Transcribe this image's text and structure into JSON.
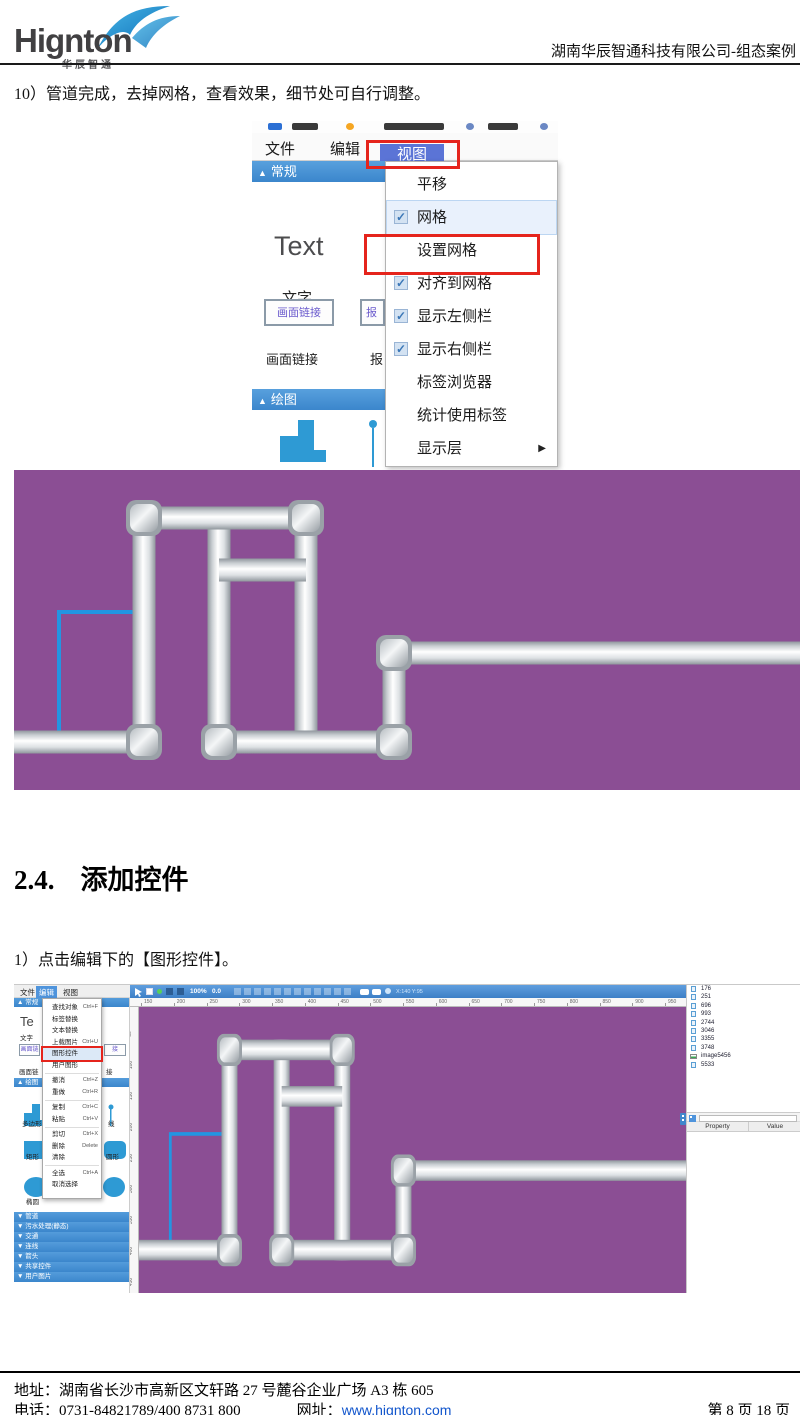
{
  "header": {
    "logo": "Hignton",
    "logo_sub": "华辰智通",
    "doc_title": "湖南华辰智通科技有限公司-组态案例"
  },
  "step10_text": "10）管道完成，去掉网格，查看效果，细节处可自行调整。",
  "section": {
    "number": "2.4.",
    "title": "添加控件"
  },
  "step1_text": "1）点击编辑下的【图形控件】。",
  "footer": {
    "address": "地址：湖南省长沙市高新区文轩路 27 号麓谷企业广场 A3 栋 605",
    "phone": "电话：0731-84821789/400 8731 800",
    "site_label": "网址：",
    "site": "www.hignton.com",
    "page_info": "第 8 页 18 页"
  },
  "shot1": {
    "menu": [
      "文件",
      "编辑",
      "视图"
    ],
    "active_menu": "视图",
    "panel": {
      "section1": "常规",
      "text_big": "Text",
      "text_label": "文字",
      "btn1": "画面链接",
      "btn2_fragment": "报",
      "label1": "画面链接",
      "label2_fragment": "报",
      "section2": "绘图"
    },
    "view_menu_items": [
      {
        "label": "平移",
        "checked": false
      },
      {
        "label": "网格",
        "checked": true,
        "highlighted": true
      },
      {
        "label": "设置网格",
        "checked": false
      },
      {
        "label": "对齐到网格",
        "checked": true
      },
      {
        "label": "显示左侧栏",
        "checked": true
      },
      {
        "label": "显示右侧栏",
        "checked": true
      },
      {
        "label": "标签浏览器",
        "checked": false
      },
      {
        "label": "统计使用标签",
        "checked": false
      },
      {
        "label": "显示层",
        "checked": false,
        "submenu": true
      }
    ]
  },
  "shot2": {
    "menu": [
      "文件",
      "编辑",
      "视图"
    ],
    "active_menu": "编辑",
    "edit_menu_items": [
      {
        "label": "查找对象",
        "shortcut": "Ctrl+F"
      },
      {
        "label": "标签替换",
        "shortcut": ""
      },
      {
        "label": "文本替换",
        "shortcut": ""
      },
      {
        "label": "上载图片",
        "shortcut": "Ctrl+U"
      },
      {
        "label": "图形控件",
        "shortcut": "",
        "highlighted": true
      },
      {
        "label": "用户图形",
        "shortcut": "",
        "sep_after": true
      },
      {
        "label": "撤消",
        "shortcut": "Ctrl+Z"
      },
      {
        "label": "重做",
        "shortcut": "Ctrl+R",
        "sep_after": true
      },
      {
        "label": "复制",
        "shortcut": "Ctrl+C"
      },
      {
        "label": "粘贴",
        "shortcut": "Ctrl+V",
        "sep_after": true
      },
      {
        "label": "剪切",
        "shortcut": "Ctrl+X"
      },
      {
        "label": "删除",
        "shortcut": "Delete"
      },
      {
        "label": "清除",
        "shortcut": "",
        "sep_after": true
      },
      {
        "label": "全选",
        "shortcut": "Ctrl+A"
      },
      {
        "label": "取消选择",
        "shortcut": ""
      }
    ],
    "toolbar": {
      "zoom": "100%",
      "angle": "0.0",
      "coords": "X:140 Y:95"
    },
    "h_ruler": [
      150,
      200,
      250,
      300,
      350,
      400,
      450,
      500,
      550,
      600,
      650,
      700,
      750,
      800,
      850,
      900,
      950
    ],
    "v_ruler": [
      50,
      100,
      150,
      200,
      250,
      300,
      350,
      400,
      450
    ],
    "sidebar": {
      "section1": "常规",
      "text_big": "Te",
      "text_label": "文字",
      "btn1": "画面链",
      "btn_fragment": "接",
      "label1": "画面链",
      "label_fragment": "接",
      "section2": "绘图",
      "shape_labels": [
        "多边形",
        "矩形",
        "椭圆"
      ],
      "fragments": [
        "线",
        "圆形"
      ],
      "collapsed_sections": [
        "管道",
        "污水处理(静态)",
        "交通",
        "连线",
        "箭头",
        "共享控件",
        "用户图片"
      ]
    },
    "tree_items": [
      {
        "icon": "page",
        "label": "176"
      },
      {
        "icon": "page",
        "label": "251"
      },
      {
        "icon": "page",
        "label": "696"
      },
      {
        "icon": "page",
        "label": "993"
      },
      {
        "icon": "page",
        "label": "2744"
      },
      {
        "icon": "page",
        "label": "3046"
      },
      {
        "icon": "page",
        "label": "3355"
      },
      {
        "icon": "page",
        "label": "3748"
      },
      {
        "icon": "image",
        "label": "image5456"
      },
      {
        "icon": "page",
        "label": "5533"
      }
    ],
    "property_panel": {
      "headers": [
        "Property",
        "Value"
      ]
    }
  },
  "pipe_diagram": {
    "background": "#8b4e94",
    "view": [
      786,
      320
    ],
    "thickness": 23,
    "blue_line": {
      "color": "#2395e2",
      "width": 4,
      "points": [
        [
          45,
          268
        ],
        [
          45,
          142
        ],
        [
          130,
          142
        ]
      ]
    },
    "segments": [
      {
        "type": "v",
        "x": 130,
        "y1": 48,
        "y2": 272
      },
      {
        "type": "v",
        "x": 292,
        "y1": 48,
        "y2": 272
      },
      {
        "type": "v",
        "x": 205,
        "y1": 48,
        "y2": 272
      },
      {
        "type": "v",
        "x": 380,
        "y1": 183,
        "y2": 272
      },
      {
        "type": "h",
        "y": 272,
        "x1": 0,
        "x2": 130
      },
      {
        "type": "h",
        "y": 48,
        "x1": 130,
        "x2": 292
      },
      {
        "type": "h",
        "y": 100,
        "x1": 205,
        "x2": 292
      },
      {
        "type": "h",
        "y": 272,
        "x1": 205,
        "x2": 380
      },
      {
        "type": "h",
        "y": 183,
        "x1": 380,
        "x2": 786
      }
    ],
    "elbows": [
      [
        130,
        272
      ],
      [
        130,
        48
      ],
      [
        292,
        48
      ],
      [
        205,
        272
      ],
      [
        380,
        272
      ],
      [
        380,
        183
      ]
    ]
  },
  "colors": {
    "accent_red": "#e5241c",
    "ui_blue": "#4f94dc",
    "header_blue": "#3f8fd9",
    "canvas_purple": "#8b4e94",
    "pipe_light": "#ffffff",
    "pipe_dark": "#8f969c",
    "blue_pipe_line": "#2395e2",
    "link_blue": "#1155cc"
  }
}
